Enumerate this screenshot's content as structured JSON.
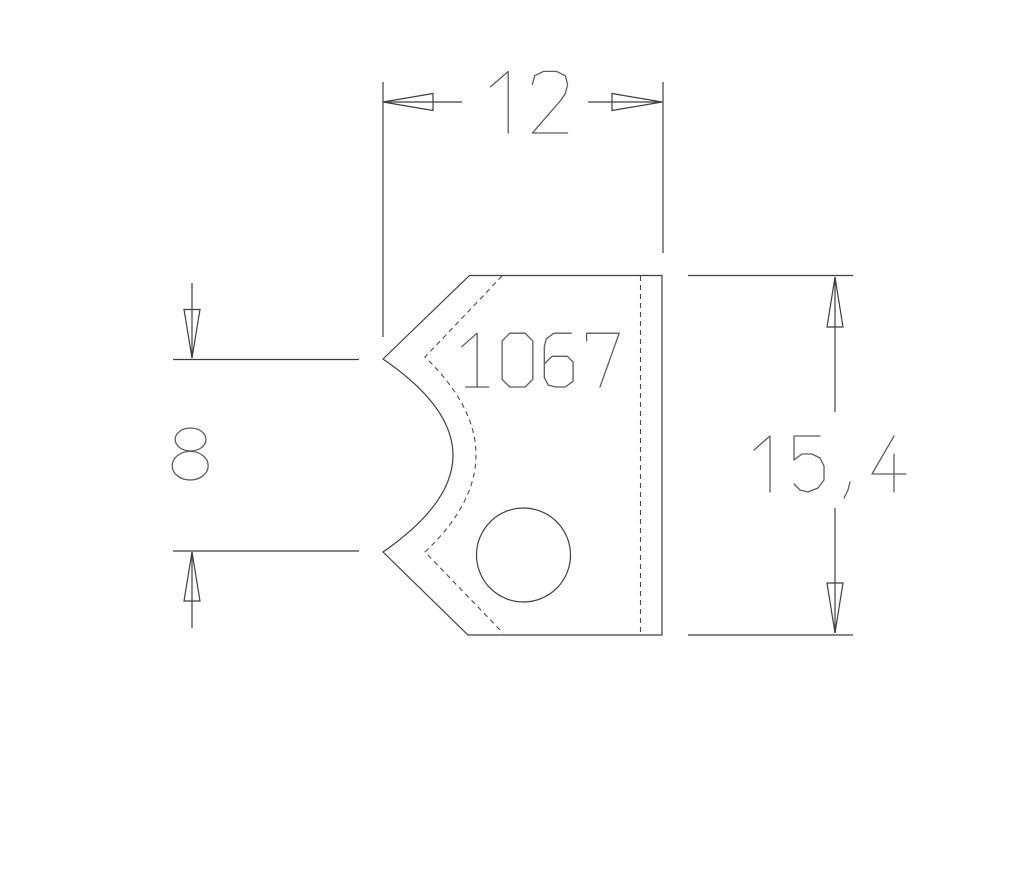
{
  "drawing": {
    "background_color": "#ffffff",
    "line_color": "#3f3f3f",
    "dashed_line_color": "#4a4a4a",
    "text_color": "#5d5d5d",
    "part": {
      "label": "1067"
    },
    "dimensions": {
      "width": {
        "value": "12"
      },
      "notch_height": {
        "value": "8"
      },
      "overall_height": {
        "value": "15, 4"
      }
    }
  }
}
